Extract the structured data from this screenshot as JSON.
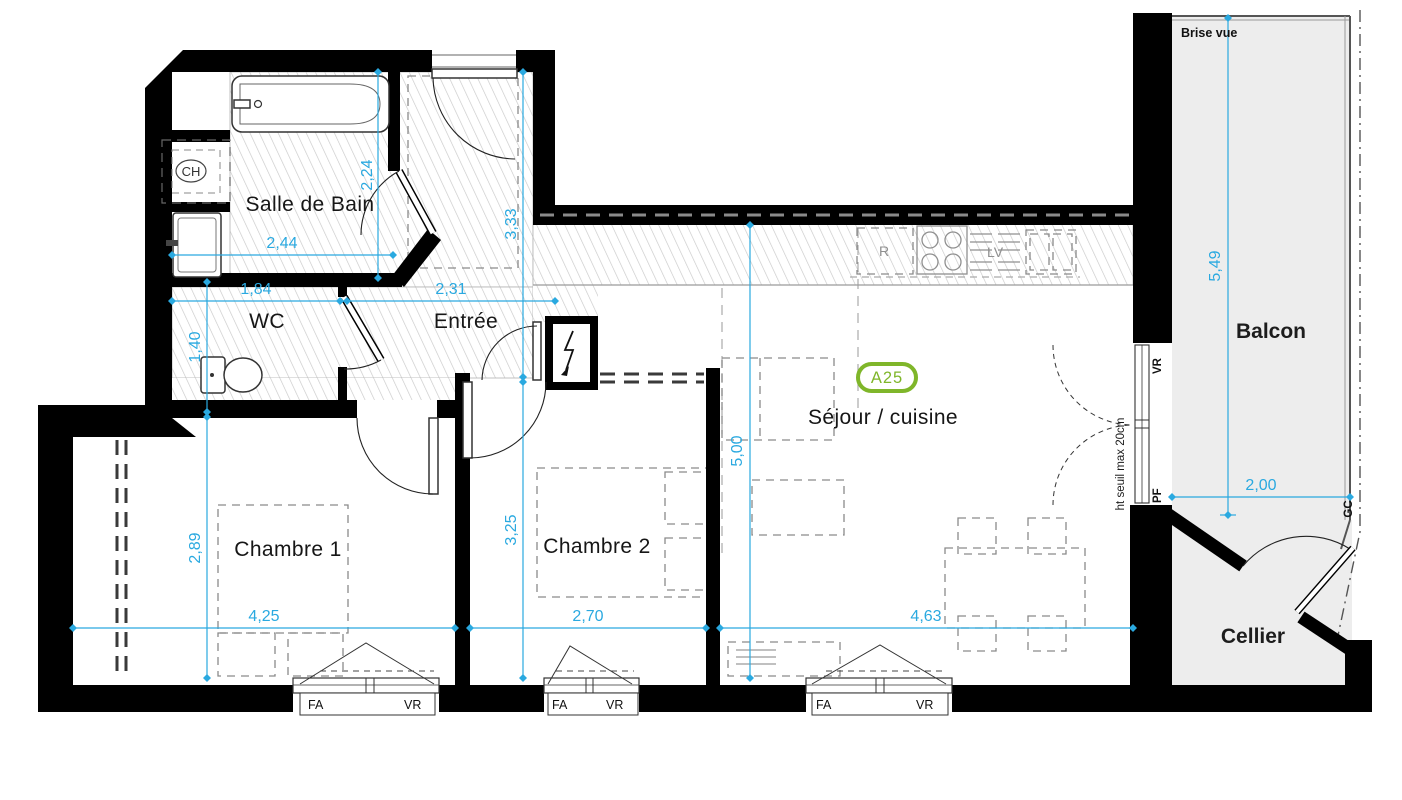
{
  "badge": "A25",
  "rooms": {
    "salle_de_bain": "Salle de Bain",
    "wc": "WC",
    "entree": "Entrée",
    "chambre1": "Chambre 1",
    "chambre2": "Chambre 2",
    "sejour": "Séjour / cuisine",
    "balcon": "Balcon",
    "cellier": "Cellier"
  },
  "dims": {
    "sdb_w": "2,44",
    "sdb_h": "2,24",
    "wc_w": "1,84",
    "wc_h": "1,40",
    "entree_w": "2,31",
    "entree_h": "3,33",
    "ch1_w": "4,25",
    "ch1_h": "2,89",
    "ch2_w": "2,70",
    "ch2_h": "3,25",
    "sejour_w": "4,63",
    "sejour_h": "5,00",
    "balcon_w": "2,00",
    "balcon_h": "5,49"
  },
  "labels": {
    "brise_vue": "Brise vue",
    "ht_seuil": "ht seuil max 20cm",
    "fa": "FA",
    "vr": "VR",
    "pf": "PF",
    "gc": "GC",
    "fridge": "R",
    "dishwasher": "LV",
    "water_heater": "CH"
  },
  "colors": {
    "dimension": "#2AA9E0",
    "badge_green": "#7fb62a",
    "wall": "#000000",
    "hatch": "#c9c9c9",
    "balcony_fill": "#ededed"
  }
}
